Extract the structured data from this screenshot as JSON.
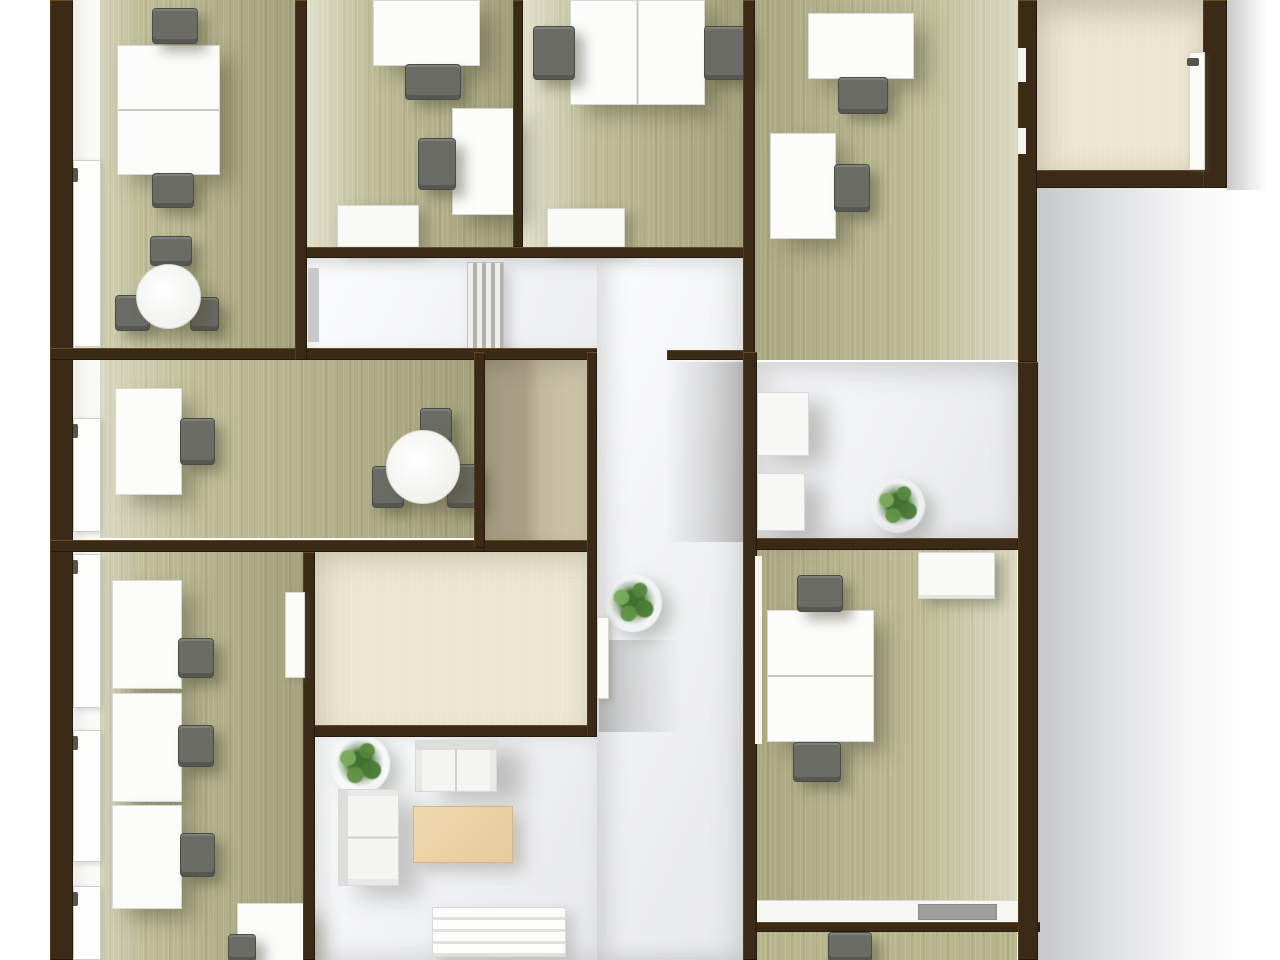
{
  "meta": {
    "description": "3D top-down rendered office floor plan, no visible text",
    "palette": {
      "wall_brown": "#3b2a15",
      "floor_green": "#b7b58c",
      "floor_cream": "#ece5cf",
      "floor_tan": "#ab9f86",
      "floor_white": "#f0f1f3",
      "desk_white": "#fcfcfb",
      "chair_gray": "#6c6c66",
      "coffee_table_beige": "#e9d2a4",
      "plant_green": "#4f7f39",
      "background": "#ffffff"
    }
  },
  "scene": {
    "width": 1280,
    "height": 960,
    "elements": [
      {
        "name": "exterior-shadow-right",
        "cls": "shade-bg-right",
        "x": 1036,
        "y": 0,
        "w": 215,
        "h": 960
      },
      {
        "name": "exterior-shadow-corner",
        "cls": "shade-corner-right",
        "x": 1227,
        "y": 0,
        "w": 40,
        "h": 190
      },
      {
        "name": "room1-floor",
        "cls": "floor-green ll",
        "x": 73,
        "y": 0,
        "w": 222,
        "h": 348
      },
      {
        "name": "room2-floor",
        "cls": "floor-green ll",
        "x": 307,
        "y": 0,
        "w": 206,
        "h": 247
      },
      {
        "name": "room3-floor",
        "cls": "floor-green ll",
        "x": 523,
        "y": 0,
        "w": 220,
        "h": 247
      },
      {
        "name": "room4-floor",
        "cls": "floor-green lr",
        "x": 755,
        "y": 0,
        "w": 263,
        "h": 360
      },
      {
        "name": "corner-room-floor",
        "cls": "floor-cream corner",
        "x": 1033,
        "y": 0,
        "w": 170,
        "h": 170
      },
      {
        "name": "corridor-floor",
        "cls": "floor-white corridor",
        "x": 307,
        "y": 258,
        "w": 436,
        "h": 92
      },
      {
        "name": "room5-floor",
        "cls": "floor-green ll",
        "x": 73,
        "y": 360,
        "w": 401,
        "h": 178
      },
      {
        "name": "storage-room-floor",
        "cls": "floor-tan",
        "x": 485,
        "y": 360,
        "w": 102,
        "h": 180
      },
      {
        "name": "hallway-floor",
        "cls": "floor-white hallway",
        "x": 597,
        "y": 258,
        "w": 146,
        "h": 702
      },
      {
        "name": "room6-floor",
        "cls": "floor-green ll",
        "x": 73,
        "y": 552,
        "w": 230,
        "h": 408
      },
      {
        "name": "cream-room-floor",
        "cls": "floor-cream",
        "x": 315,
        "y": 552,
        "w": 272,
        "h": 181
      },
      {
        "name": "lounge-floor",
        "cls": "floor-white lounge",
        "x": 315,
        "y": 737,
        "w": 282,
        "h": 223
      },
      {
        "name": "room7-floor",
        "cls": "floor-white room7",
        "x": 755,
        "y": 362,
        "w": 263,
        "h": 176
      },
      {
        "name": "room8-floor",
        "cls": "floor-green lr",
        "x": 755,
        "y": 550,
        "w": 262,
        "h": 372
      },
      {
        "name": "room9-floor",
        "cls": "floor-green",
        "x": 755,
        "y": 932,
        "w": 262,
        "h": 28
      },
      {
        "name": "hallway-wall-shadow-upper",
        "cls": "shade-to-left",
        "x": 666,
        "y": 362,
        "w": 77,
        "h": 180
      },
      {
        "name": "hallway-wall-shadow-lower",
        "cls": "shade-to-right",
        "x": 599,
        "y": 640,
        "w": 82,
        "h": 92
      },
      {
        "name": "left-window-strip",
        "cls": "window-strip",
        "x": 73,
        "y": 0,
        "w": 27,
        "h": 960
      },
      {
        "name": "window-frame-1",
        "cls": "window-frame",
        "x": 73,
        "y": 160,
        "w": 26,
        "h": 185
      },
      {
        "name": "window-frame-2",
        "cls": "window-frame",
        "x": 73,
        "y": 418,
        "w": 26,
        "h": 112
      },
      {
        "name": "window-frame-3",
        "cls": "window-frame",
        "x": 73,
        "y": 554,
        "w": 26,
        "h": 152
      },
      {
        "name": "window-frame-4",
        "cls": "window-frame",
        "x": 73,
        "y": 730,
        "w": 26,
        "h": 130
      },
      {
        "name": "window-frame-5",
        "cls": "window-frame",
        "x": 73,
        "y": 886,
        "w": 26,
        "h": 72
      },
      {
        "name": "window-handle-1",
        "cls": "handle",
        "x": 70,
        "y": 168,
        "w": 8,
        "h": 14
      },
      {
        "name": "window-handle-2",
        "cls": "handle",
        "x": 70,
        "y": 424,
        "w": 8,
        "h": 14
      },
      {
        "name": "window-handle-3",
        "cls": "handle",
        "x": 70,
        "y": 560,
        "w": 8,
        "h": 14
      },
      {
        "name": "window-handle-4",
        "cls": "handle",
        "x": 70,
        "y": 736,
        "w": 8,
        "h": 14
      },
      {
        "name": "window-handle-5",
        "cls": "handle",
        "x": 70,
        "y": 892,
        "w": 8,
        "h": 14
      },
      {
        "name": "corridor-radiator",
        "cls": "radiator",
        "x": 467,
        "y": 262,
        "w": 35,
        "h": 88
      },
      {
        "name": "room1-desk",
        "cls": "desk split-h",
        "x": 117,
        "y": 45,
        "w": 101,
        "h": 128
      },
      {
        "name": "room1-desk-chair-top",
        "cls": "chair",
        "x": 152,
        "y": 8,
        "w": 44,
        "h": 34
      },
      {
        "name": "room1-desk-chair-bottom",
        "cls": "chair",
        "x": 152,
        "y": 173,
        "w": 40,
        "h": 33
      },
      {
        "name": "room1-table-chair-north",
        "cls": "chair",
        "x": 150,
        "y": 236,
        "w": 40,
        "h": 28
      },
      {
        "name": "room1-table-chair-west",
        "cls": "chair",
        "x": 115,
        "y": 295,
        "w": 33,
        "h": 34
      },
      {
        "name": "room1-table-chair-east",
        "cls": "chair",
        "x": 190,
        "y": 297,
        "w": 27,
        "h": 32
      },
      {
        "name": "room1-round-table",
        "cls": "table-round",
        "x": 136,
        "y": 264,
        "w": 63,
        "h": 63
      },
      {
        "name": "room2-desk-top",
        "cls": "desk",
        "x": 373,
        "y": 0,
        "w": 105,
        "h": 64
      },
      {
        "name": "room2-desk-top-chair",
        "cls": "chair",
        "x": 405,
        "y": 64,
        "w": 54,
        "h": 34
      },
      {
        "name": "room2-desk-side",
        "cls": "desk",
        "x": 452,
        "y": 108,
        "w": 61,
        "h": 105
      },
      {
        "name": "room2-desk-side-chair",
        "cls": "chair",
        "x": 418,
        "y": 138,
        "w": 36,
        "h": 50
      },
      {
        "name": "room2-cabinet",
        "cls": "cabinet",
        "x": 337,
        "y": 205,
        "w": 80,
        "h": 43
      },
      {
        "name": "room3-double-desk",
        "cls": "desk split-v",
        "x": 570,
        "y": 0,
        "w": 133,
        "h": 103
      },
      {
        "name": "room3-chair-left",
        "cls": "chair",
        "x": 533,
        "y": 26,
        "w": 40,
        "h": 52
      },
      {
        "name": "room3-chair-right",
        "cls": "chair",
        "x": 704,
        "y": 26,
        "w": 41,
        "h": 52
      },
      {
        "name": "room3-cabinet",
        "cls": "cabinet",
        "x": 547,
        "y": 208,
        "w": 76,
        "h": 40
      },
      {
        "name": "room4-desk-top",
        "cls": "desk",
        "x": 808,
        "y": 13,
        "w": 104,
        "h": 64
      },
      {
        "name": "room4-desk-top-chair",
        "cls": "chair",
        "x": 838,
        "y": 77,
        "w": 48,
        "h": 35
      },
      {
        "name": "room4-desk-side",
        "cls": "desk",
        "x": 770,
        "y": 133,
        "w": 64,
        "h": 104
      },
      {
        "name": "room4-desk-side-chair",
        "cls": "chair",
        "x": 834,
        "y": 164,
        "w": 34,
        "h": 46
      },
      {
        "name": "room5-desk",
        "cls": "desk",
        "x": 115,
        "y": 388,
        "w": 65,
        "h": 105
      },
      {
        "name": "room5-desk-chair",
        "cls": "chair",
        "x": 180,
        "y": 418,
        "w": 33,
        "h": 45
      },
      {
        "name": "room5-table-chair-north",
        "cls": "chair",
        "x": 420,
        "y": 408,
        "w": 30,
        "h": 34
      },
      {
        "name": "room5-table-chair-east",
        "cls": "chair",
        "x": 447,
        "y": 464,
        "w": 30,
        "h": 42
      },
      {
        "name": "room5-table-chair-west",
        "cls": "chair",
        "x": 372,
        "y": 466,
        "w": 30,
        "h": 40
      },
      {
        "name": "room5-round-table",
        "cls": "table-round",
        "x": 386,
        "y": 430,
        "w": 72,
        "h": 72
      },
      {
        "name": "room6-desk-1",
        "cls": "desk",
        "x": 112,
        "y": 580,
        "w": 68,
        "h": 107
      },
      {
        "name": "room6-desk-1-chair",
        "cls": "chair",
        "x": 178,
        "y": 638,
        "w": 34,
        "h": 38
      },
      {
        "name": "room6-desk-2",
        "cls": "desk",
        "x": 112,
        "y": 693,
        "w": 68,
        "h": 107
      },
      {
        "name": "room6-desk-2-chair",
        "cls": "chair",
        "x": 178,
        "y": 725,
        "w": 34,
        "h": 40
      },
      {
        "name": "room6-desk-3",
        "cls": "desk",
        "x": 112,
        "y": 805,
        "w": 68,
        "h": 102
      },
      {
        "name": "room6-desk-3-chair",
        "cls": "chair",
        "x": 180,
        "y": 833,
        "w": 33,
        "h": 42
      },
      {
        "name": "room6-desk-4",
        "cls": "desk",
        "x": 237,
        "y": 903,
        "w": 70,
        "h": 57
      },
      {
        "name": "room6-desk-4-chair",
        "cls": "chair",
        "x": 228,
        "y": 934,
        "w": 26,
        "h": 26
      },
      {
        "name": "lounge-plant",
        "cls": "plant",
        "x": 330,
        "y": 734,
        "w": 60,
        "h": 60
      },
      {
        "name": "lounge-loveseat",
        "cls": "sofa-south",
        "x": 415,
        "y": 740,
        "w": 80,
        "h": 50
      },
      {
        "name": "lounge-armchair",
        "cls": "sofa-east",
        "x": 338,
        "y": 789,
        "w": 59,
        "h": 95
      },
      {
        "name": "lounge-coffee-table",
        "cls": "table-beige",
        "x": 413,
        "y": 806,
        "w": 98,
        "h": 55
      },
      {
        "name": "lounge-bench",
        "cls": "bench",
        "x": 432,
        "y": 907,
        "w": 132,
        "h": 48
      },
      {
        "name": "hallway-plant",
        "cls": "plant",
        "x": 604,
        "y": 574,
        "w": 58,
        "h": 58
      },
      {
        "name": "room7-shelf-upper",
        "cls": "shelf",
        "x": 757,
        "y": 392,
        "w": 50,
        "h": 62
      },
      {
        "name": "room7-shelf-lower",
        "cls": "shelf",
        "x": 757,
        "y": 473,
        "w": 46,
        "h": 56
      },
      {
        "name": "room7-plant",
        "cls": "plant",
        "x": 870,
        "y": 478,
        "w": 55,
        "h": 55
      },
      {
        "name": "room8-cabinet",
        "cls": "cabinet",
        "x": 918,
        "y": 552,
        "w": 75,
        "h": 45
      },
      {
        "name": "room8-double-desk",
        "cls": "desk split-h",
        "x": 767,
        "y": 610,
        "w": 105,
        "h": 130
      },
      {
        "name": "room8-chair-top",
        "cls": "chair",
        "x": 797,
        "y": 575,
        "w": 44,
        "h": 35
      },
      {
        "name": "room8-chair-bottom",
        "cls": "chair",
        "x": 793,
        "y": 742,
        "w": 46,
        "h": 38
      },
      {
        "name": "room8-counter",
        "cls": "counter",
        "x": 755,
        "y": 900,
        "w": 263,
        "h": 22
      },
      {
        "name": "room8-counter-tray",
        "cls": "tray",
        "x": 918,
        "y": 904,
        "w": 77,
        "h": 14
      },
      {
        "name": "room9-chair",
        "cls": "chair",
        "x": 828,
        "y": 932,
        "w": 42,
        "h": 28
      },
      {
        "name": "wall-outer-left",
        "cls": "wall",
        "x": 50,
        "y": 0,
        "w": 23,
        "h": 960
      },
      {
        "name": "wall-h-top-rooms-bottom",
        "cls": "wall",
        "x": 295,
        "y": 247,
        "w": 460,
        "h": 11
      },
      {
        "name": "wall-h-mid-upper-left",
        "cls": "wall",
        "x": 50,
        "y": 348,
        "w": 547,
        "h": 12
      },
      {
        "name": "wall-h-mid-upper-right",
        "cls": "wall",
        "x": 667,
        "y": 350,
        "w": 88,
        "h": 10
      },
      {
        "name": "wall-h-mid-lower-left",
        "cls": "wall",
        "x": 50,
        "y": 540,
        "w": 547,
        "h": 12
      },
      {
        "name": "wall-h-mid-lower-right",
        "cls": "wall",
        "x": 745,
        "y": 538,
        "w": 273,
        "h": 12
      },
      {
        "name": "wall-h-cream-room-bottom",
        "cls": "wall",
        "x": 307,
        "y": 725,
        "w": 290,
        "h": 12
      },
      {
        "name": "wall-h-room8-bottom",
        "cls": "wall",
        "x": 745,
        "y": 922,
        "w": 295,
        "h": 10
      },
      {
        "name": "wall-h-corner-room-bottom",
        "cls": "wall",
        "x": 1033,
        "y": 170,
        "w": 194,
        "h": 18
      },
      {
        "name": "wall-v-room1-right",
        "cls": "wall",
        "x": 295,
        "y": 0,
        "w": 12,
        "h": 360
      },
      {
        "name": "wall-v-room2-right",
        "cls": "wall",
        "x": 513,
        "y": 0,
        "w": 10,
        "h": 247
      },
      {
        "name": "wall-v-room3-right",
        "cls": "wall",
        "x": 743,
        "y": 0,
        "w": 12,
        "h": 362
      },
      {
        "name": "wall-v-room4-right",
        "cls": "wall",
        "x": 1018,
        "y": 0,
        "w": 19,
        "h": 362
      },
      {
        "name": "wall-v-corner-room-right",
        "cls": "wall",
        "x": 1203,
        "y": 0,
        "w": 24,
        "h": 188
      },
      {
        "name": "wall-v-room5-right",
        "cls": "wall",
        "x": 474,
        "y": 352,
        "w": 11,
        "h": 196
      },
      {
        "name": "wall-v-storage-right",
        "cls": "wall",
        "x": 587,
        "y": 352,
        "w": 10,
        "h": 385
      },
      {
        "name": "wall-v-hallway-right",
        "cls": "wall",
        "x": 743,
        "y": 352,
        "w": 14,
        "h": 608
      },
      {
        "name": "wall-v-room8-right",
        "cls": "wall",
        "x": 1018,
        "y": 362,
        "w": 20,
        "h": 598
      },
      {
        "name": "wall-v-room6-right",
        "cls": "wall",
        "x": 303,
        "y": 552,
        "w": 12,
        "h": 408
      },
      {
        "name": "room4-window-sliver-1",
        "cls": "window-sliver",
        "x": 1018,
        "y": 48,
        "w": 8,
        "h": 34
      },
      {
        "name": "room4-window-sliver-2",
        "cls": "window-sliver",
        "x": 1018,
        "y": 128,
        "w": 8,
        "h": 26
      },
      {
        "name": "room8-window-sliver",
        "cls": "window-sliver",
        "x": 755,
        "y": 556,
        "w": 7,
        "h": 188
      },
      {
        "name": "corner-room-door",
        "cls": "door-white",
        "x": 1189,
        "y": 52,
        "w": 14,
        "h": 116
      },
      {
        "name": "corner-room-door-handle",
        "cls": "handle",
        "x": 1187,
        "y": 58,
        "w": 12,
        "h": 8
      },
      {
        "name": "room6-door",
        "cls": "door-white",
        "x": 285,
        "y": 592,
        "w": 18,
        "h": 84
      },
      {
        "name": "hallway-door",
        "cls": "door-white",
        "x": 597,
        "y": 617,
        "w": 10,
        "h": 80
      },
      {
        "name": "corridor-door",
        "cls": "door-gray",
        "x": 308,
        "y": 268,
        "w": 11,
        "h": 74
      }
    ]
  }
}
